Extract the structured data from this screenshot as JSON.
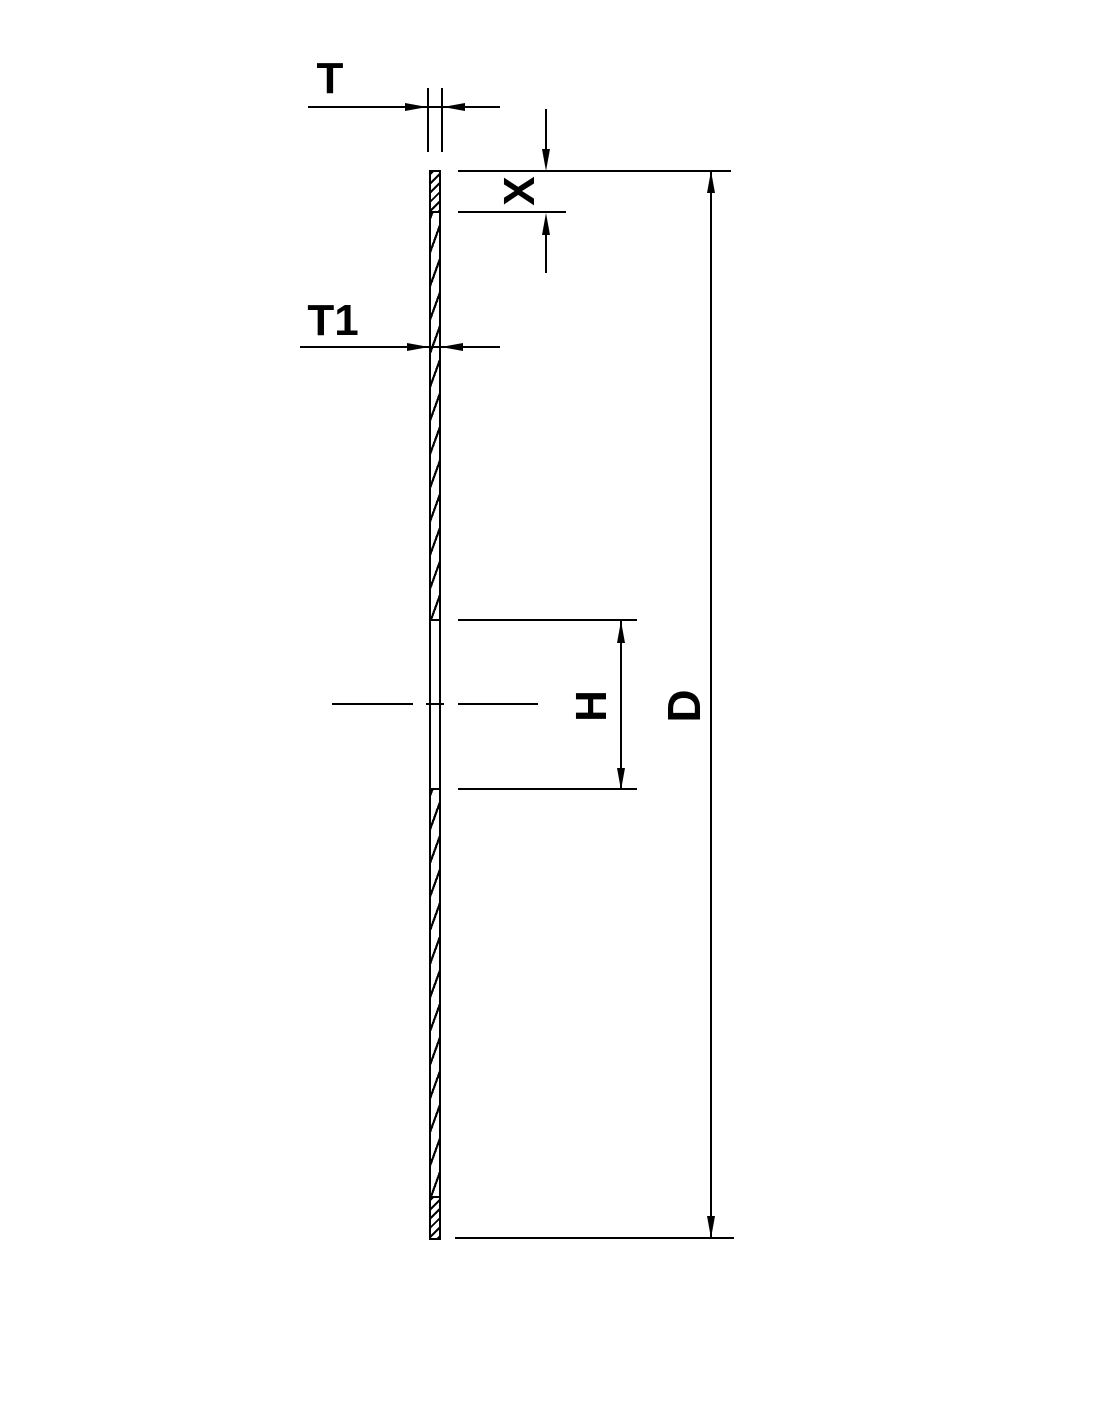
{
  "drawing": {
    "labels": {
      "t": "T",
      "t1": "T1",
      "x": "X",
      "h": "H",
      "d": "D"
    },
    "colors": {
      "ink": "#000000",
      "background": "#ffffff"
    }
  }
}
